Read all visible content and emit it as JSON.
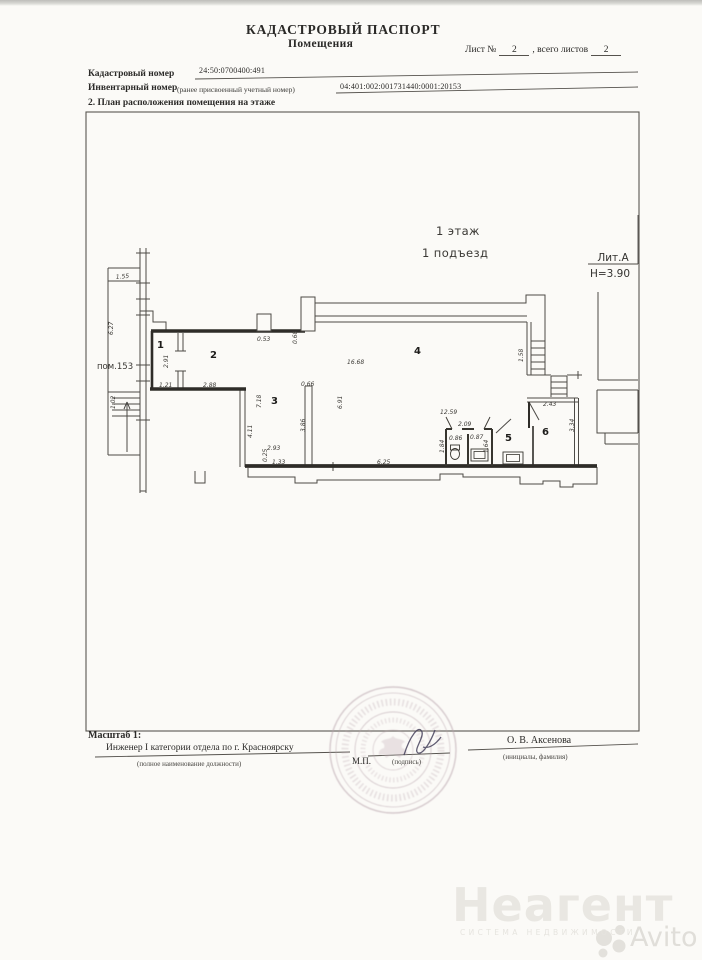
{
  "header": {
    "title_line1": "КАДАСТРОВЫЙ ПАСПОРТ",
    "title_line2": "Помещения",
    "sheet_label": "Лист №",
    "sheet_number": "2",
    "sheet_total_label": ", всего листов",
    "sheet_total": "2",
    "cadastral_label": "Кадастровый номер",
    "cadastral_value": "24:50:0700400:491",
    "inventory_label": "Инвентарный номер",
    "inventory_note": "(ранее присвоенный учетный номер)",
    "inventory_value": "04:401:002:001731440:0001:20153",
    "section_title": "2. План расположения помещения на этаже"
  },
  "plan": {
    "floor_label": "1 этаж",
    "entrance_label": "1 подъезд",
    "liter_label": "Лит.А",
    "height_label": "H=3.90",
    "labels": [
      {
        "t": "1.55",
        "x": 116,
        "y": 279,
        "r": -5,
        "k": "dim"
      },
      {
        "t": "6.27",
        "x": 113,
        "y": 335,
        "r": -90,
        "k": "dim"
      },
      {
        "t": "пом.153",
        "x": 97,
        "y": 369,
        "k": "note"
      },
      {
        "t": "1.02",
        "x": 115,
        "y": 409,
        "r": -90,
        "k": "dim"
      },
      {
        "t": "1",
        "x": 157,
        "y": 348,
        "k": "room"
      },
      {
        "t": "2.91",
        "x": 168,
        "y": 368,
        "r": -90,
        "k": "dim"
      },
      {
        "t": "1.21",
        "x": 159,
        "y": 387,
        "k": "dim"
      },
      {
        "t": "2",
        "x": 210,
        "y": 358,
        "k": "room"
      },
      {
        "t": "2.88",
        "x": 203,
        "y": 387,
        "k": "dim"
      },
      {
        "t": "0.53",
        "x": 257,
        "y": 341,
        "k": "dim"
      },
      {
        "t": "0.68",
        "x": 297,
        "y": 344,
        "r": -90,
        "k": "dim"
      },
      {
        "t": "3",
        "x": 271,
        "y": 404,
        "k": "room"
      },
      {
        "t": "7.18",
        "x": 261,
        "y": 408,
        "r": -90,
        "k": "dim"
      },
      {
        "t": "4.11",
        "x": 252,
        "y": 438,
        "r": -90,
        "k": "dim"
      },
      {
        "t": "2.93",
        "x": 267,
        "y": 450,
        "k": "dim"
      },
      {
        "t": "0.25",
        "x": 267,
        "y": 462,
        "r": -90,
        "k": "dim"
      },
      {
        "t": "1.33",
        "x": 272,
        "y": 464,
        "k": "dim"
      },
      {
        "t": "0.66",
        "x": 301,
        "y": 386,
        "k": "dim"
      },
      {
        "t": "3.86",
        "x": 305,
        "y": 432,
        "r": -90,
        "k": "dim"
      },
      {
        "t": "6.91",
        "x": 342,
        "y": 409,
        "r": -90,
        "k": "dim"
      },
      {
        "t": "4",
        "x": 414,
        "y": 354,
        "k": "room"
      },
      {
        "t": "16.68",
        "x": 347,
        "y": 364,
        "k": "dim"
      },
      {
        "t": "6.25",
        "x": 377,
        "y": 464,
        "k": "dim"
      },
      {
        "t": "12.59",
        "x": 440,
        "y": 414,
        "k": "dim"
      },
      {
        "t": "2.09",
        "x": 458,
        "y": 426,
        "k": "dim"
      },
      {
        "t": "0.86",
        "x": 449,
        "y": 440,
        "k": "dim"
      },
      {
        "t": "0.87",
        "x": 470,
        "y": 439,
        "k": "dim"
      },
      {
        "t": "1.84",
        "x": 444,
        "y": 453,
        "r": -90,
        "k": "dim"
      },
      {
        "t": "1.64",
        "x": 488,
        "y": 453,
        "r": -90,
        "k": "dim"
      },
      {
        "t": "5",
        "x": 505,
        "y": 441,
        "k": "room"
      },
      {
        "t": "6",
        "x": 542,
        "y": 435,
        "k": "room"
      },
      {
        "t": "2.43",
        "x": 543,
        "y": 406,
        "k": "dim"
      },
      {
        "t": "3.34",
        "x": 574,
        "y": 432,
        "r": -90,
        "k": "dim"
      },
      {
        "t": "1.58",
        "x": 523,
        "y": 362,
        "r": -90,
        "k": "dim"
      }
    ]
  },
  "footer": {
    "scale_label": "Масштаб 1:",
    "position_value": "Инженер I категории отдела по г. Красноярску",
    "position_note": "(полное наименование должности)",
    "stamp_label": "М.П.",
    "signature_note": "(подпись)",
    "name_value": "О. В. Аксенова",
    "name_note": "(инициалы, фамилия)"
  },
  "watermark": {
    "brand": "Неагент",
    "brand_sub": "СИСТЕМА НЕДВИЖИМОСТИ",
    "avito": "Avito"
  },
  "colors": {
    "page_bg": "#fbfaf7",
    "plan_line": "#4c4a46",
    "plan_wall": "#2e2c28",
    "stamp": "#b7a3ab",
    "watermark": "#e8e6e1"
  }
}
